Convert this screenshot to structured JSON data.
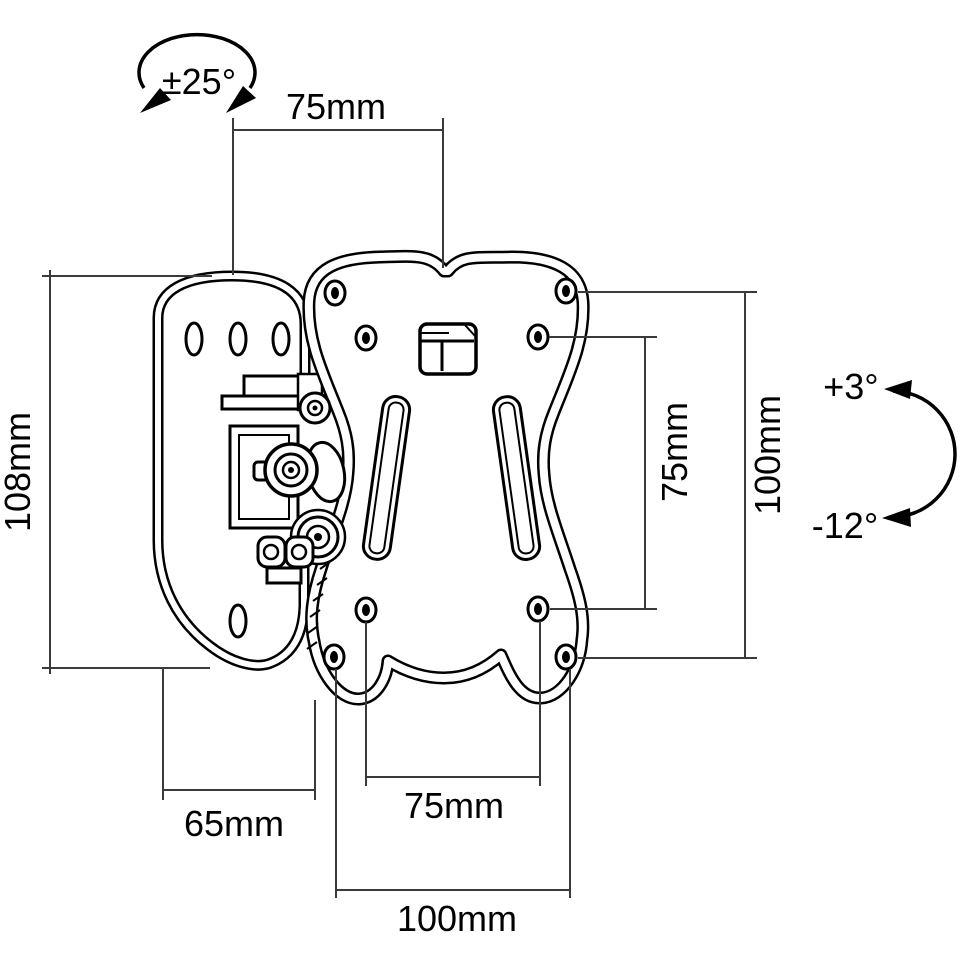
{
  "figure": {
    "type": "technical-drawing",
    "background": "#ffffff",
    "line_color": "#000000",
    "dimension_color": "#3a3a3a"
  },
  "annotations": {
    "swivel": "±25°",
    "tilt_up": "+3°",
    "tilt_down": "-12°"
  },
  "dimensions": {
    "top_width": "75mm",
    "left_height": "108mm",
    "side_hole_spacing": "75mm",
    "side_plate_height": "100mm",
    "bottom_offset": "65mm",
    "bottom_hole_spacing": "75mm",
    "bottom_plate_width": "100mm"
  }
}
